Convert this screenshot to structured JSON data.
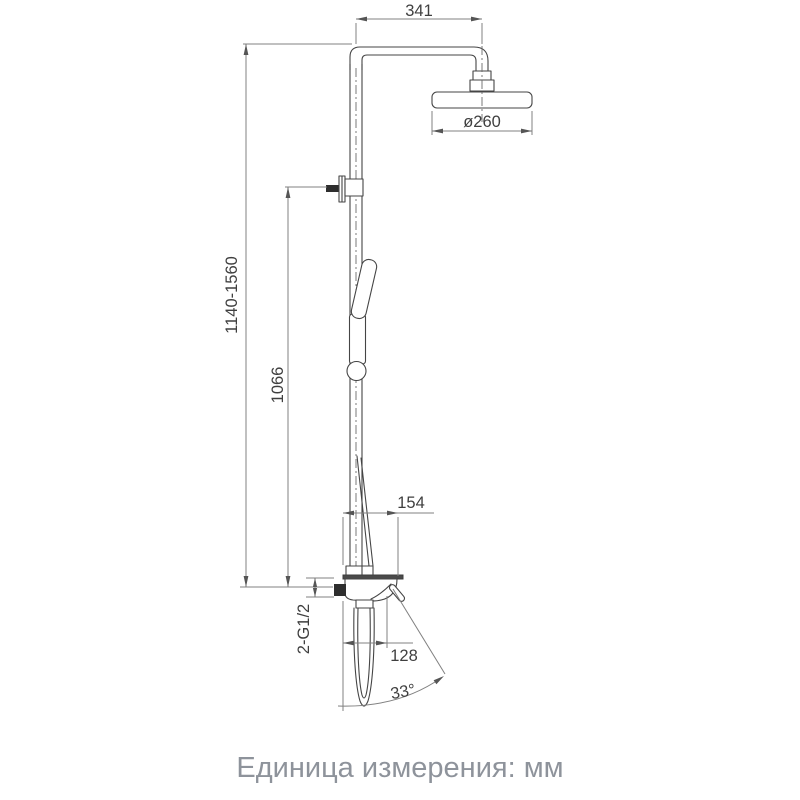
{
  "labels": {
    "top_width": "341",
    "head_diameter": "ø260",
    "total_height": "1140-1560",
    "bracket_height": "1066",
    "body_depth": "154",
    "inlet_thread": "2-G1/2",
    "spout_reach": "128",
    "swivel_angle": "33°"
  },
  "caption": "Единица измерения: мм",
  "colors": {
    "part_line": "#454545",
    "dimension_line": "#808080",
    "dimension_text": "#3f3f3f",
    "caption_text": "#8e939b",
    "background": "#ffffff"
  }
}
